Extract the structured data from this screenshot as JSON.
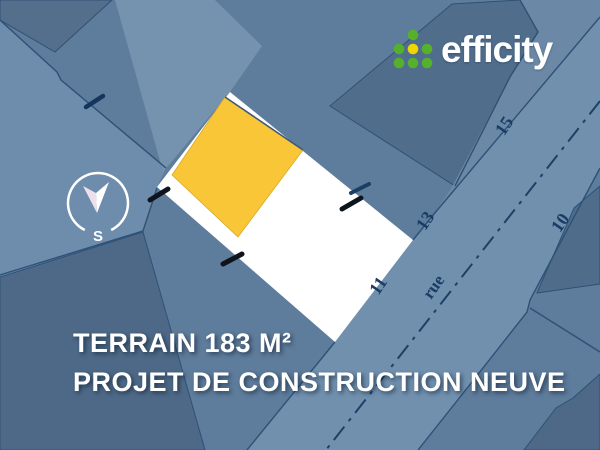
{
  "logo": {
    "brand": "efficity",
    "dot_green": "#55B02C",
    "dot_yellow": "#F1D500"
  },
  "compass": {
    "south_label": "S"
  },
  "map": {
    "street_label": "rue",
    "house_numbers": [
      "15",
      "13",
      "11",
      "10"
    ]
  },
  "caption": {
    "line1": "TERRAIN 183 M²",
    "line2": "PROJET DE CONSTRUCTION NEUVE"
  },
  "colors": {
    "map_base": "#5E7C9B",
    "road": "#7090AE",
    "road_left_band": "#6E8CAB",
    "driveway_strip": "#7592AF",
    "road_upper_wedge": "#6B89A7",
    "dark_parcel": "#506E8C",
    "dark_parcel_bottom": "#4D6987",
    "dark_corner_topleft": "#546F8C",
    "parcel_fill": "#FFFFFF",
    "building_yellow": "#F8C637",
    "boundary_line": "#2E5177",
    "centerline_navy": "#1E4066",
    "label_navy": "#1B3C64",
    "marker_black": "#0D141C",
    "marker_navy": "#1C3E66",
    "caption_text": "#FFFFFF"
  }
}
